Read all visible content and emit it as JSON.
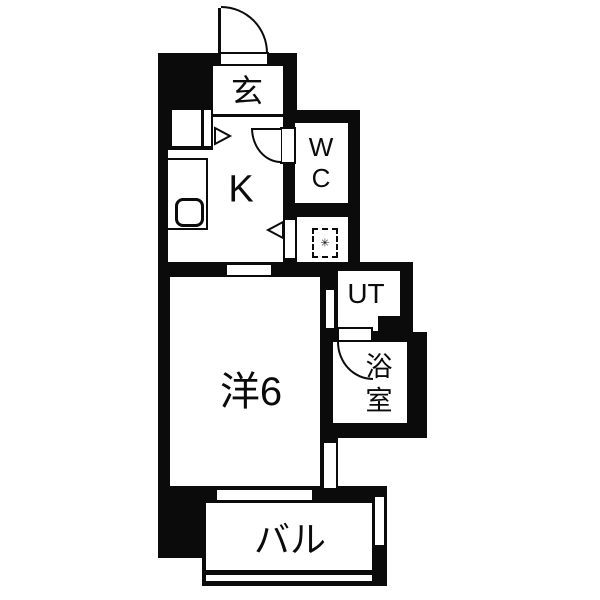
{
  "floorplan": {
    "type": "apartment-floor-plan",
    "rooms": {
      "genkan": {
        "label": "玄"
      },
      "kitchen": {
        "label": "K"
      },
      "wc": {
        "line1": "W",
        "line2": "C"
      },
      "ut": {
        "label": "UT"
      },
      "western": {
        "label": "洋6"
      },
      "bath": {
        "line1": "浴",
        "line2": "室"
      },
      "balcony": {
        "label": "バル"
      }
    },
    "symbols": {
      "ps_marker": "✳"
    },
    "colors": {
      "wall": "#0b0b0b",
      "floor": "#ffffff"
    }
  }
}
